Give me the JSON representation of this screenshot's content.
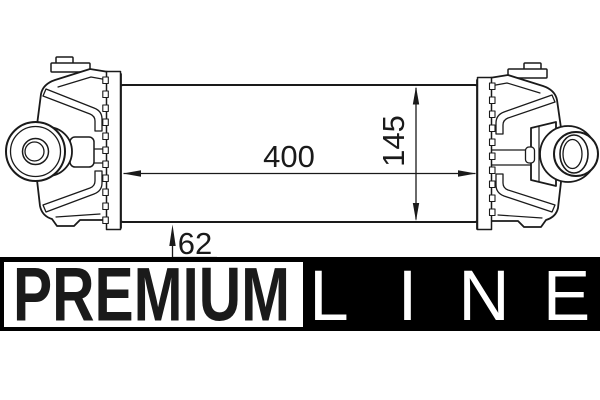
{
  "title": "Intercooler (charge air cooler) technical line drawing with Premium Line brand bar",
  "drawing": {
    "type": "technical-line-drawing",
    "part": "intercooler-front-view",
    "background": "#ffffff",
    "line_color": "#1a1a1a"
  },
  "dimensions": {
    "width": "400",
    "height": "145",
    "depth": "62"
  },
  "logo": {
    "premium_label": "PREMIUM",
    "line_label": "LINE",
    "line_letters": [
      "L",
      "I",
      "N",
      "E"
    ],
    "bar_bg": "#000000",
    "premium_box_bg": "#ffffff",
    "premium_text_color": "#000000",
    "line_text_color": "#ffffff"
  }
}
